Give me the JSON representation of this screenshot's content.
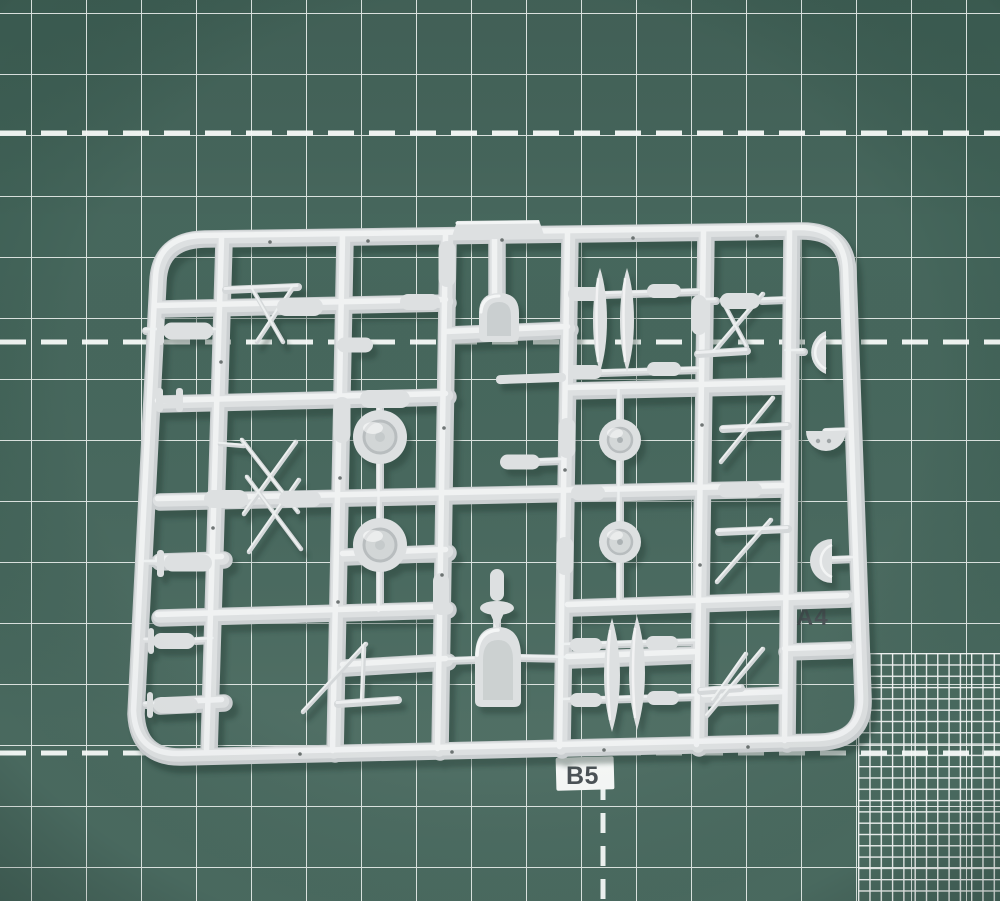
{
  "scene": {
    "type": "photograph",
    "subject": "Light grey plastic model-kit sprue with small aircraft parts lying on a green self-healing cutting mat"
  },
  "mat": {
    "labels": {
      "a4": "A4",
      "b5": "B5"
    },
    "grid": {
      "major_cell_px": 55,
      "fine_cell_px": 11,
      "fine_grid_position": "bottom-right",
      "dashed_horizontal_guides_y": [
        133,
        342,
        753
      ],
      "dashed_vertical_guide_x": 603
    }
  },
  "colors": {
    "mat_green": "#3f6156",
    "mat_green_light": "#4a6b60",
    "grid_line": "#eef3f0",
    "fine_grid_line": "#f8faf9",
    "sprue_plastic": "#ced2d3",
    "sprue_plastic_mid": "#dde0e1",
    "sprue_highlight": "#f2f4f4",
    "sprue_shadow": "#142e27",
    "label_text": "#454c50",
    "b5_patch": "#f4f6f5"
  },
  "sprue": {
    "part_types": [
      "rounded rectangular frame runner",
      "injection gate tab",
      "bombs and drop tanks",
      "seaplane floats",
      "main wheels with hubs",
      "engine cowlings",
      "half cowl shells",
      "landing gear and rigging struts",
      "propeller spinner"
    ]
  }
}
